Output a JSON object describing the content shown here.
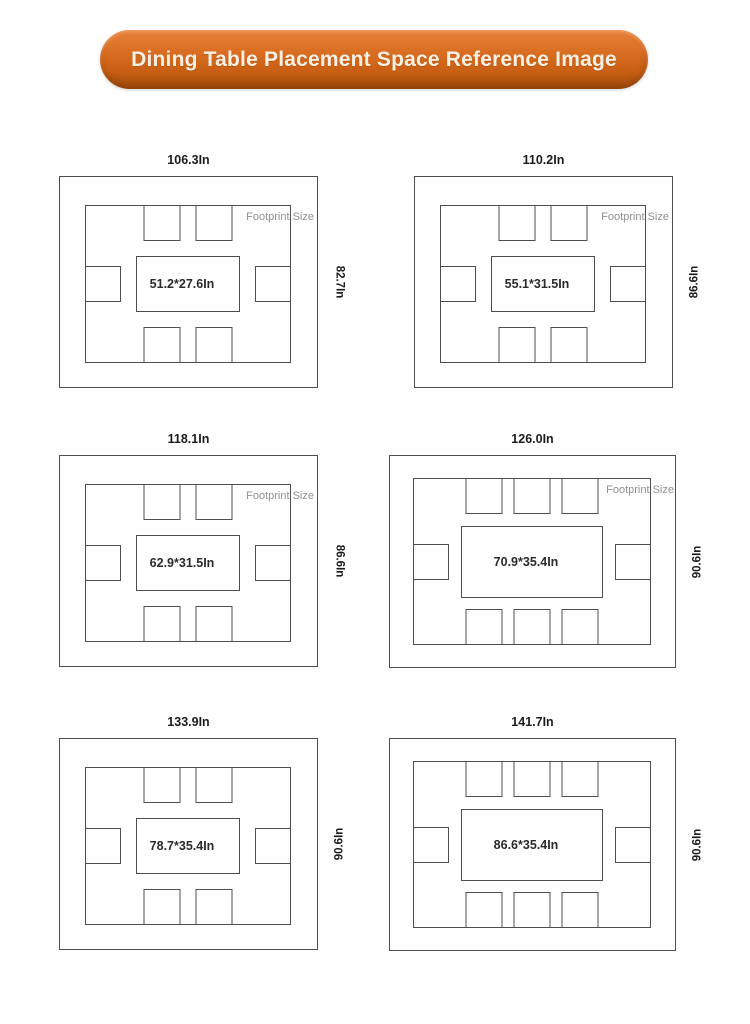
{
  "banner": {
    "title": "Dining Table Placement Space Reference Image"
  },
  "colors": {
    "banner_orange": "#d2691e",
    "banner_orange_dark": "#a04c0e",
    "banner_text": "#f9f0e4",
    "outline_gray": "#4e4e4e",
    "footprint_text_gray": "#8f8f8f",
    "dimension_text": "#1c1c1c",
    "background": "#ffffff"
  },
  "unit": "In",
  "diagrams": [
    {
      "width_label": "106.3In",
      "depth_label": "82.7In",
      "table_label": "51.2*27.6In",
      "footprint_label": "Footprint Size",
      "chairs": {
        "top": 2,
        "bottom": 2,
        "left": 1,
        "right": 1
      }
    },
    {
      "width_label": "110.2In",
      "depth_label": "86.6In",
      "table_label": "55.1*31.5In",
      "footprint_label": "Footprint Size",
      "chairs": {
        "top": 2,
        "bottom": 2,
        "left": 1,
        "right": 1
      }
    },
    {
      "width_label": "118.1In",
      "depth_label": "86.6In",
      "table_label": "62.9*31.5In",
      "footprint_label": "Footprint Size",
      "chairs": {
        "top": 2,
        "bottom": 2,
        "left": 1,
        "right": 1
      }
    },
    {
      "width_label": "126.0In",
      "depth_label": "90.6In",
      "table_label": "70.9*35.4In",
      "footprint_label": "Footprint Size",
      "chairs": {
        "top": 3,
        "bottom": 3,
        "left": 1,
        "right": 1
      }
    },
    {
      "width_label": "133.9In",
      "depth_label": "90.6In",
      "table_label": "78.7*35.4In",
      "footprint_label": "",
      "chairs": {
        "top": 2,
        "bottom": 2,
        "left": 1,
        "right": 1
      }
    },
    {
      "width_label": "141.7In",
      "depth_label": "90.6In",
      "table_label": "86.6*35.4In",
      "footprint_label": "",
      "chairs": {
        "top": 3,
        "bottom": 3,
        "left": 1,
        "right": 1
      }
    }
  ]
}
